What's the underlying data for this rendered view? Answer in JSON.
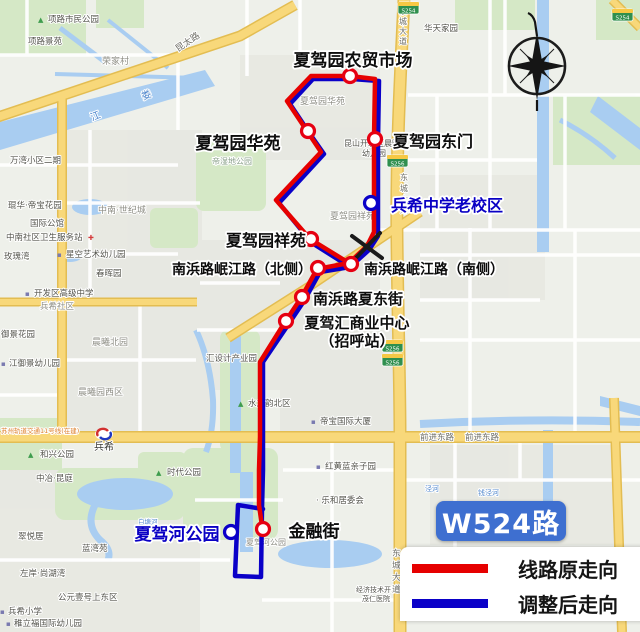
{
  "badge": {
    "label": "W524路"
  },
  "legend": {
    "original_label": "线路原走向",
    "adjusted_label": "调整后走向"
  },
  "colors": {
    "route_original": "#e60000",
    "route_adjusted": "#0a00c8",
    "stop_ring_red": "#e60012",
    "stop_ring_blue": "#0a00c8",
    "new_stop_text": "#0a00c4",
    "badge_bg": "#3e6fd0",
    "water": "#a9cdf1",
    "park": "#d5e8c6",
    "road_major": "#f8d87a"
  },
  "stops": [
    {
      "name": "夏驾园农贸市场",
      "x": 350,
      "y": 76,
      "ring": "red",
      "lx": 353,
      "ly": 66,
      "ls": 17,
      "la": "middle"
    },
    {
      "name": "夏驾园华苑",
      "x": 308,
      "y": 131,
      "ring": "red",
      "lx": 238,
      "ly": 149,
      "ls": 17,
      "la": "middle"
    },
    {
      "name": "夏驾园东门",
      "x": 375,
      "y": 139,
      "ring": "red",
      "lx": 433,
      "ly": 147,
      "ls": 16,
      "la": "middle"
    },
    {
      "name": "兵希中学老校区",
      "x": 371,
      "y": 203,
      "ring": "blue",
      "lc": "#0a00c4",
      "lx": 447,
      "ly": 211,
      "ls": 16,
      "la": "middle"
    },
    {
      "name": "夏驾园祥苑",
      "x": 311,
      "y": 239,
      "ring": "red",
      "lx": 266,
      "ly": 246,
      "ls": 16,
      "la": "middle"
    },
    {
      "name": "南浜路岷江路（北侧）",
      "x": 318,
      "y": 268,
      "ring": "red",
      "lx": 242,
      "ly": 274,
      "ls": 14,
      "la": "middle"
    },
    {
      "name": "南浜路岷江路（南侧）",
      "x": 351,
      "y": 264,
      "ring": "red",
      "lx": 434,
      "ly": 274,
      "ls": 14,
      "la": "middle"
    },
    {
      "name": "南浜路夏东街",
      "x": 302,
      "y": 297,
      "ring": "red",
      "lx": 358,
      "ly": 304,
      "ls": 15,
      "la": "middle"
    },
    {
      "name": "夏驾汇商业中心",
      "x": 286,
      "y": 321,
      "ring": "red",
      "lx": 357,
      "ly": 328,
      "ls": 15,
      "la": "middle",
      "label2": "（招呼站）",
      "l2x": 357,
      "l2y": 346
    },
    {
      "name": "金融街",
      "x": 263,
      "y": 529,
      "ring": "red",
      "lx": 314,
      "ly": 537,
      "ls": 17,
      "la": "middle"
    },
    {
      "name": "夏驾河公园",
      "x": 231,
      "y": 532,
      "ring": "blue",
      "lc": "#0a00c4",
      "lx": 177,
      "ly": 540,
      "ls": 17,
      "la": "middle"
    }
  ],
  "removed_stop": {
    "x": 367,
    "y": 246
  },
  "map_labels": [
    {
      "t": "项路市民公园",
      "x": 48,
      "y": 22
    },
    {
      "t": "项路景苑",
      "x": 28,
      "y": 44
    },
    {
      "t": "荣家村",
      "x": 102,
      "y": 64,
      "c": "#8d8d84",
      "s": 9
    },
    {
      "t": "华天家园",
      "x": 424,
      "y": 31
    },
    {
      "t": "万湾小区二期",
      "x": 10,
      "y": 163
    },
    {
      "t": "琨华·帝宝花园",
      "x": 8,
      "y": 208
    },
    {
      "t": "国际公馆",
      "x": 30,
      "y": 226
    },
    {
      "t": "中南社区卫生服务站",
      "x": 6,
      "y": 240
    },
    {
      "t": "玫瑰湾",
      "x": 4,
      "y": 259
    },
    {
      "t": "星空艺术幼儿园",
      "x": 66,
      "y": 257
    },
    {
      "t": "中南·世纪城",
      "x": 98,
      "y": 213,
      "c": "#8d8d84",
      "s": 9
    },
    {
      "t": "春晖园",
      "x": 96,
      "y": 276
    },
    {
      "t": "开发区高级中学",
      "x": 34,
      "y": 296
    },
    {
      "t": "兵希社区",
      "x": 40,
      "y": 309,
      "c": "#8d8d84"
    },
    {
      "t": "御景花园",
      "x": 1,
      "y": 337
    },
    {
      "t": "江御景幼儿园",
      "x": 9,
      "y": 366
    },
    {
      "t": "晨曦北园",
      "x": 92,
      "y": 345,
      "c": "#8d8d84",
      "s": 9
    },
    {
      "t": "晨曦园西区",
      "x": 78,
      "y": 395,
      "c": "#8d8d84",
      "s": 9
    },
    {
      "t": "汇设计产业园",
      "x": 206,
      "y": 361
    },
    {
      "t": "和兴公园",
      "x": 40,
      "y": 457
    },
    {
      "t": "时代公园",
      "x": 167,
      "y": 475
    },
    {
      "t": "中冶·昆庭",
      "x": 36,
      "y": 481
    },
    {
      "t": "翠悦居",
      "x": 18,
      "y": 539
    },
    {
      "t": "蓝湾苑",
      "x": 82,
      "y": 551
    },
    {
      "t": "左岸·尚湖湾",
      "x": 20,
      "y": 576
    },
    {
      "t": "公元壹号上东区",
      "x": 58,
      "y": 600
    },
    {
      "t": "兵希小学",
      "x": 8,
      "y": 614
    },
    {
      "t": "稚立福国际幼儿园",
      "x": 14,
      "y": 626
    },
    {
      "t": "水之韵北区",
      "x": 248,
      "y": 406
    },
    {
      "t": "帝宝国际大厦",
      "x": 320,
      "y": 424
    },
    {
      "t": "红黄蓝亲子园",
      "x": 325,
      "y": 469
    },
    {
      "t": "· 乐和居委会",
      "x": 316,
      "y": 503
    },
    {
      "t": "夏驾园华苑",
      "x": 300,
      "y": 104,
      "c": "#8d8d84",
      "s": 9
    },
    {
      "t": "夏驾园祥苑",
      "x": 330,
      "y": 219,
      "c": "#8d8d84",
      "s": 9
    },
    {
      "t": "昆山开发区晨曦",
      "x": 344,
      "y": 146,
      "s": 8
    },
    {
      "t": "幼儿园",
      "x": 362,
      "y": 156,
      "s": 8
    },
    {
      "t": "帝湿地公园",
      "x": 212,
      "y": 164,
      "c": "#8aa08a",
      "s": 8
    },
    {
      "t": "夏驾河公园",
      "x": 246,
      "y": 545,
      "c": "#8d8d84",
      "s": 8
    },
    {
      "t": "经济技术开发区",
      "x": 356,
      "y": 592,
      "s": 7
    },
    {
      "t": "茂仁医院",
      "x": 362,
      "y": 601,
      "s": 7
    },
    {
      "t": "昆太路",
      "x": 178,
      "y": 52,
      "s": 9,
      "c": "#6e6e66",
      "r": -34
    },
    {
      "t": "前进东路",
      "x": 420,
      "y": 440,
      "s": 8.5,
      "c": "#6e6e66"
    },
    {
      "t": "前进东路",
      "x": 465,
      "y": 440,
      "s": 8.5,
      "c": "#6e6e66"
    },
    {
      "t": "兵希",
      "x": 94,
      "y": 450,
      "s": 10,
      "c": "#3a3a36"
    },
    {
      "t": "苏州轨道交通11号线(在建)",
      "x": 1,
      "y": 433,
      "s": 6.5,
      "c": "#dd7f2b"
    },
    {
      "t": "娄",
      "x": 143,
      "y": 100,
      "s": 10,
      "c": "#4f86cc",
      "r": -22
    },
    {
      "t": "江",
      "x": 92,
      "y": 121,
      "s": 10,
      "c": "#4f86cc",
      "r": -22
    },
    {
      "t": "白塘河",
      "x": 138,
      "y": 524,
      "s": 6.5,
      "c": "#4f86cc"
    },
    {
      "t": "钱泾河",
      "x": 478,
      "y": 495,
      "s": 7,
      "c": "#4f86cc"
    },
    {
      "t": "泾河",
      "x": 425,
      "y": 491,
      "s": 7,
      "c": "#4f86cc"
    },
    {
      "t": "东",
      "x": 399,
      "y": 14,
      "s": 8,
      "c": "#6e6e66"
    },
    {
      "t": "城",
      "x": 399,
      "y": 24,
      "s": 8,
      "c": "#6e6e66"
    },
    {
      "t": "大",
      "x": 399,
      "y": 34,
      "s": 8,
      "c": "#6e6e66"
    },
    {
      "t": "道",
      "x": 399,
      "y": 44,
      "s": 8,
      "c": "#6e6e66"
    },
    {
      "t": "东",
      "x": 400,
      "y": 180,
      "s": 8,
      "c": "#6e6e66"
    },
    {
      "t": "城",
      "x": 400,
      "y": 191,
      "s": 8,
      "c": "#6e6e66"
    },
    {
      "t": "大",
      "x": 400,
      "y": 202,
      "s": 8,
      "c": "#6e6e66"
    },
    {
      "t": "道",
      "x": 400,
      "y": 213,
      "s": 8,
      "c": "#6e6e66"
    },
    {
      "t": "东",
      "x": 392,
      "y": 556,
      "s": 8.5,
      "c": "#6e6e66"
    },
    {
      "t": "城",
      "x": 392,
      "y": 568,
      "s": 8.5,
      "c": "#6e6e66"
    },
    {
      "t": "大",
      "x": 392,
      "y": 580,
      "s": 8.5,
      "c": "#6e6e66"
    },
    {
      "t": "道",
      "x": 392,
      "y": 592,
      "s": 8.5,
      "c": "#6e6e66"
    }
  ],
  "map_icons": [
    {
      "g": "▲",
      "x": 38,
      "y": 22,
      "c": "#3f9d4e"
    },
    {
      "g": "▲",
      "x": 28,
      "y": 457,
      "c": "#3f9d4e"
    },
    {
      "g": "▲",
      "x": 156,
      "y": 475,
      "c": "#3f9d4e"
    },
    {
      "g": "▲",
      "x": 238,
      "y": 406,
      "c": "#3f9d4e"
    },
    {
      "g": "✚",
      "x": 88,
      "y": 240,
      "c": "#d43c3c"
    },
    {
      "g": "▪",
      "x": 57,
      "y": 257,
      "c": "#7a7ab0"
    },
    {
      "g": "▪",
      "x": 25,
      "y": 296,
      "c": "#7a7ab0"
    },
    {
      "g": "▪",
      "x": 1,
      "y": 366,
      "c": "#7a7ab0"
    },
    {
      "g": "▪",
      "x": 311,
      "y": 424,
      "c": "#7a7ab0"
    },
    {
      "g": "▪",
      "x": 316,
      "y": 469,
      "c": "#7a7ab0"
    },
    {
      "g": "▪",
      "x": 0,
      "y": 614,
      "c": "#7a7ab0"
    },
    {
      "g": "▪",
      "x": 6,
      "y": 626,
      "c": "#7a7ab0"
    }
  ],
  "road_badges": [
    {
      "t": "S254",
      "x": 398,
      "y": 2
    },
    {
      "t": "S254",
      "x": 612,
      "y": 9
    },
    {
      "t": "S256",
      "x": 387,
      "y": 155
    },
    {
      "t": "S256",
      "x": 382,
      "y": 340
    },
    {
      "t": "S256",
      "x": 382,
      "y": 354
    }
  ]
}
